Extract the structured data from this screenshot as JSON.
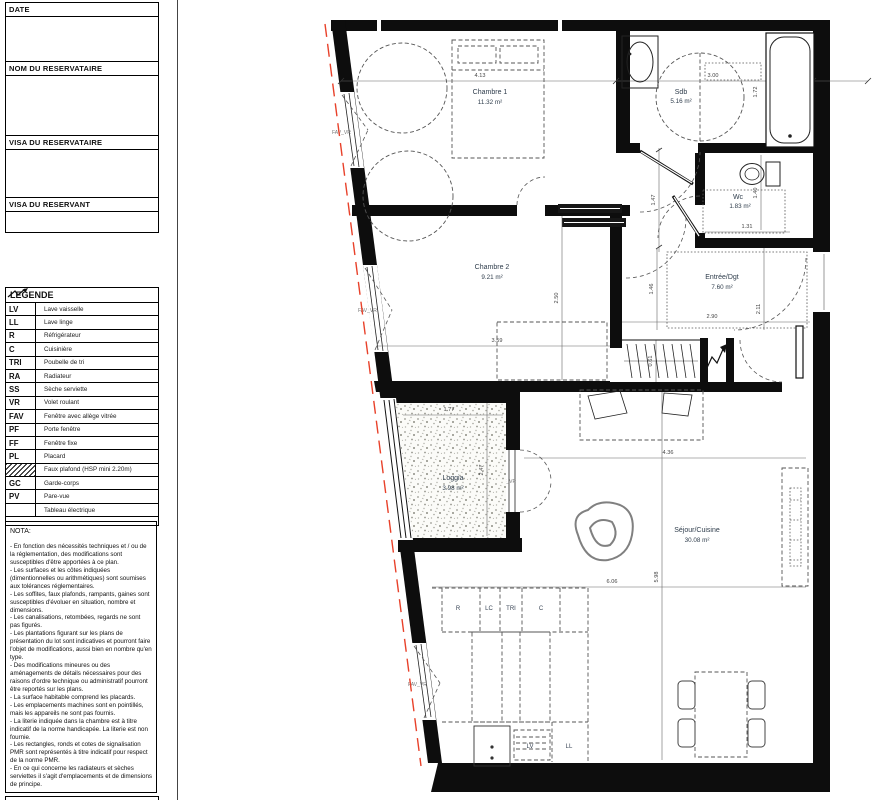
{
  "panel": {
    "form_fields": [
      "DATE",
      "NOM DU RESERVATAIRE",
      "VISA DU RESERVATAIRE",
      "VISA DU RESERVANT"
    ],
    "legend": {
      "title": "LEGENDE",
      "items": [
        {
          "code": "LV",
          "label": "Lave vaisselle"
        },
        {
          "code": "LL",
          "label": "Lave linge"
        },
        {
          "code": "R",
          "label": "Réfrigérateur"
        },
        {
          "code": "C",
          "label": "Cuisinière"
        },
        {
          "code": "TRI",
          "label": "Poubelle de tri"
        },
        {
          "code": "RA",
          "label": "Radiateur"
        },
        {
          "code": "SS",
          "label": "Sèche serviette"
        },
        {
          "code": "VR",
          "label": "Volet roulant"
        },
        {
          "code": "FAV",
          "label": "Fenêtre avec allège vitrée"
        },
        {
          "code": "PF",
          "label": "Porte fenêtre"
        },
        {
          "code": "FF",
          "label": "Fenêtre fixe"
        },
        {
          "code": "PL",
          "label": "Placard"
        },
        {
          "code": "",
          "label": "Faux plafond (HSP mini 2.20m)",
          "symbol": "hatch"
        },
        {
          "code": "GC",
          "label": "Garde-corps"
        },
        {
          "code": "PV",
          "label": "Pare-vue"
        },
        {
          "code": "",
          "label": "Tableau électrique",
          "symbol": "zigzag"
        }
      ]
    },
    "nota": {
      "title": "NOTA:",
      "body": "- En fonction des nécessités techniques et / ou de la réglementation, des modifications sont susceptibles d'être apportées à ce plan.\n- Les surfaces et les côtes indiquées (dimentionnelles ou arithmétiques) sont soumises aux tolérances réglementaires.\n- Les soffites, faux plafonds, rampants, gaines sont susceptibles d'évoluer en situation, nombre et dimensions.\n- Les canalisations, retombées, regards ne sont pas figurés.\n- Les plantations figurant sur les plans de présentation du lot sont indicatives et pourront faire l'objet de modifications, aussi bien en nombre qu'en type.\n- Des modifications mineures ou des aménagements de détails nécessaires pour des raisons d'ordre technique ou administratif pourront être reportés sur les plans.\n- La surface habitable comprend les placards.\n- Les emplacements machines sont en pointillés, mais les appareils ne sont pas fournis.\n- La literie indiquée dans la chambre est à titre indicatif de la norme handicapée. La literie est non fournie.\n- Les rectangles, ronds et cotes de signalisation PMR sont représentés à titre indicatif pour respect de la norme PMR.\n- En ce qui concerne les radiateurs et sèches serviettes  il s'agit d'emplacements et de dimensions de principe."
    }
  },
  "plan": {
    "rooms": {
      "chambre1": {
        "name": "Chambre 1",
        "area": "11.32 m²"
      },
      "sdb": {
        "name": "Sdb",
        "area": "5.16 m²"
      },
      "wc": {
        "name": "Wc",
        "area": "1.83 m²"
      },
      "chambre2": {
        "name": "Chambre 2",
        "area": "9.21 m²"
      },
      "entree": {
        "name": "Entrée/Dgt",
        "area": "7.60 m²"
      },
      "loggia": {
        "name": "Loggia",
        "area": "3.98 m²"
      },
      "sejour": {
        "name": "Séjour/Cuisine",
        "area": "30.08 m²"
      }
    },
    "dims": {
      "chambre1_w": "4.13",
      "sdb_w": "3.00",
      "sdb_d": "1.72",
      "hall_h": "1.47",
      "wc_w": "1.31",
      "wc_d": "1.40",
      "chambre2_d": "2.50",
      "chambre2_w": "3.59",
      "entree_h": "1.46",
      "entree_w": "2.90",
      "entree_d": "2.11",
      "placard_d": "0.61",
      "loggia_w": "1.77",
      "loggia_d": "2.47",
      "sejour_w": "4.36",
      "sejour_d": "5.98",
      "sejour_total_w": "6.06"
    },
    "kitchen": {
      "r": "R",
      "lc": "LC",
      "tri": "TRI",
      "c": "C",
      "lv": "LV",
      "ll": "LL"
    },
    "windows": {
      "w_chambre1": "FAV_VR",
      "w_chambre2": "FAV_VR",
      "w_loggia": "PF_VR",
      "w_cuisine": "FAV_VR"
    },
    "colors": {
      "wall": "#0d0d0d",
      "red_line": "#e8412a",
      "label": "#2f3d4c",
      "dim": "#444444"
    }
  }
}
